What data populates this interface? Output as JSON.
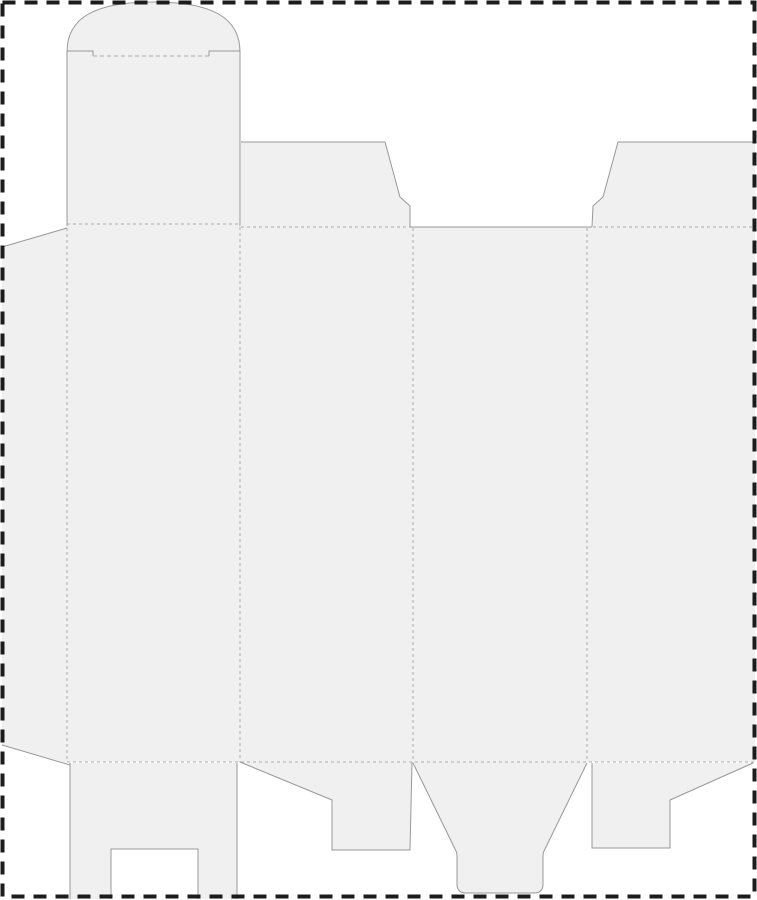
{
  "document": {
    "type": "packaging-dieline-template",
    "description": "flat die-cut layout of a folding tuck-top carton with glue flap, dust flaps, snap-lock bottom flaps and dashed artboard border"
  },
  "canvas": {
    "width": 757,
    "height": 900,
    "background": "#ffffff"
  },
  "colors": {
    "panel_fill": "#f0f0f1",
    "cut_stroke": "#989898",
    "fold_stroke": "#ababab",
    "border_stroke": "#1c1c1c"
  },
  "border": {
    "x": 2.5,
    "y": 2.5,
    "width": 752,
    "height": 894,
    "stroke_width": 4,
    "dash": "13 9"
  },
  "dieline": {
    "fills": [
      {
        "name": "tuck-flap-dome",
        "d": "M 67,52 C 67,17 96,2 153.5,2 C 211,2 240,17 240,52 Z"
      },
      {
        "name": "top-lid-flap",
        "d": "M 67,51 L 240,51 L 240,225 L 67,225 Z"
      },
      {
        "name": "glue-flap",
        "d": "M 2,247 L 67,228 L 67,763 L 2,745 Z"
      },
      {
        "name": "main-panels",
        "d": "M 67,224 L 240,224 L 240,227 L 755,227 L 755,762 L 67,762 Z"
      },
      {
        "name": "dust-flap-left",
        "d": "M 241,142 L 385,142 L 400,197 L 410,206 L 410,228 L 241,228 Z"
      },
      {
        "name": "dust-flap-right",
        "d": "M 618,142 L 755,142 L 755,228 L 593,228 L 593,206 L 603,197 Z"
      },
      {
        "name": "bottom-flap-panel1",
        "d": "M 70,763 L 237,763 L 237,899 L 198,899 L 198,849 L 111,849 L 111,899 L 70,899 Z"
      },
      {
        "name": "bottom-flap-panel2",
        "d": "M 240,762 L 412,762 L 410,850 L 332,850 L 332,800 Z"
      },
      {
        "name": "bottom-tuck-panel3",
        "d": "M 413,762 L 587,762 L 544,851 Q 543,853 543,856 L 543,884 Q 543,893 534,893 L 466,893 Q 457,893 457,884 L 457,856 Q 457,853 456,851 Z"
      },
      {
        "name": "bottom-flap-panel4",
        "d": "M 592,763 L 755,763 L 670,800 L 670,848 L 592,848 Z"
      }
    ],
    "cuts": [
      {
        "name": "glue-flap-top-edge",
        "d": "M 2,247 L 67,228"
      },
      {
        "name": "glue-flap-bottom-edge",
        "d": "M 2,745 L 70,765"
      },
      {
        "name": "lid-left-edge-shoulder",
        "d": "M 67,226 L 67,51 L 93,51 L 93,56"
      },
      {
        "name": "lid-right-edge-shoulder",
        "d": "M 209,56 L 209,51 L 240,51 L 240,226"
      },
      {
        "name": "tuck-dome-arc",
        "d": "M 67,52 C 67,17 96,2 153.5,2 C 211,2 240,17 240,52"
      },
      {
        "name": "dust-flap-left-edge",
        "d": "M 241,142 L 385,142 L 400,197 L 410,206 L 410,227"
      },
      {
        "name": "top-center-cut-edge",
        "d": "M 410,227 L 592,227"
      },
      {
        "name": "dust-flap-right-edge",
        "d": "M 592,227 L 593,206 L 603,197 L 618,142 L 755,142"
      },
      {
        "name": "flap1-left-edge",
        "d": "M 70,763 L 70,899"
      },
      {
        "name": "flap1-right-edge",
        "d": "M 237,763 L 237,899"
      },
      {
        "name": "flap1-notch-cut",
        "d": "M 111,899 L 111,849 L 198,849 L 198,899"
      },
      {
        "name": "flap2-cut-edge",
        "d": "M 240,762 L 332,800 L 332,850 L 410,850 L 412,762"
      },
      {
        "name": "tuck3-cut-edge",
        "d": "M 413,763 L 456,851 Q 457,853 457,856 L 457,884 Q 457,893 466,893 L 534,893 Q 543,893 543,884 L 543,856 Q 543,853 544,851 L 587,763"
      },
      {
        "name": "flap4-cut-edge",
        "d": "M 592,763 L 592,848 L 670,848 L 670,800 L 753,763"
      }
    ],
    "folds": [
      {
        "name": "tuck-fold-line",
        "d": "M 93,56 L 209,56",
        "dash": "4 3"
      },
      {
        "name": "lid-fold-line",
        "d": "M 67,224 L 240,224",
        "dash": "3 3"
      },
      {
        "name": "dust-left-fold-line",
        "d": "M 241,227 L 410,227",
        "dash": "3 3"
      },
      {
        "name": "dust-right-fold-line",
        "d": "M 593,227 L 754,227",
        "dash": "3 3"
      },
      {
        "name": "glue-fold-line",
        "d": "M 67,228 L 67,762",
        "dash": "3 3"
      },
      {
        "name": "panel-fold-line-2",
        "d": "M 240,227 L 240,762",
        "dash": "3 3"
      },
      {
        "name": "panel-fold-line-3",
        "d": "M 413,228 L 413,762",
        "dash": "3 3"
      },
      {
        "name": "panel-fold-line-4",
        "d": "M 587,228 L 587,762",
        "dash": "3 3"
      },
      {
        "name": "bottom-fold-line",
        "d": "M 67,762 L 754,762",
        "dash": "3 3"
      }
    ]
  }
}
